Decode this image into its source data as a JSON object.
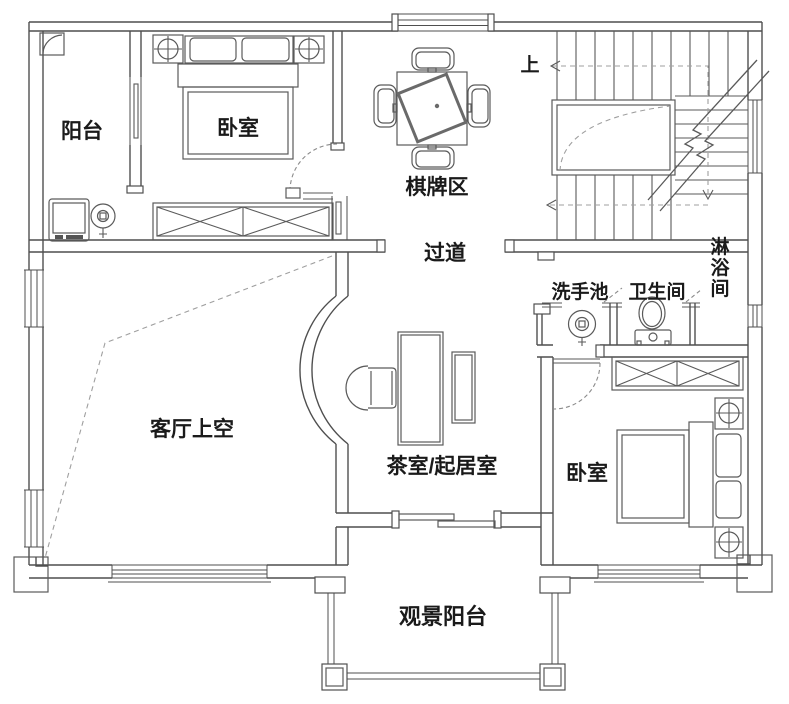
{
  "plan": {
    "type": "floor-plan",
    "language": "zh-CN",
    "rooms": {
      "balcony_north": "阳台",
      "bedroom_north": "卧室",
      "chess_card_area": "棋牌区",
      "corridor": "过道",
      "washbasin_area": "洗手池",
      "toilet_room": "卫生间",
      "shower_room": "淋浴间",
      "living_room_void": "客厅上空",
      "tea_living_room": "茶室/起居室",
      "bedroom_south": "卧室",
      "view_balcony": "观景阳台"
    },
    "annotations": {
      "stairs_up": "上"
    },
    "fixtures": [
      "washing-machine-icon",
      "floor-drain-icon",
      "double-bed-icon",
      "nightstand-lamp-icon",
      "wardrobe-cross-icon",
      "mahjong-table-icon",
      "chair-icon",
      "staircase-icon",
      "tea-table-icon",
      "bench-icon",
      "armchair-icon",
      "washbasin-icon",
      "toilet-icon",
      "sliding-door-icon",
      "door-swing-icon",
      "window-icon",
      "railing-icon"
    ],
    "colors": {
      "wall_line": "#4f4f4f",
      "furniture_line": "#5a5a5a",
      "dashed_line": "#9f9f9f",
      "label_text": "#1a1a1a",
      "background": "#ffffff"
    }
  }
}
